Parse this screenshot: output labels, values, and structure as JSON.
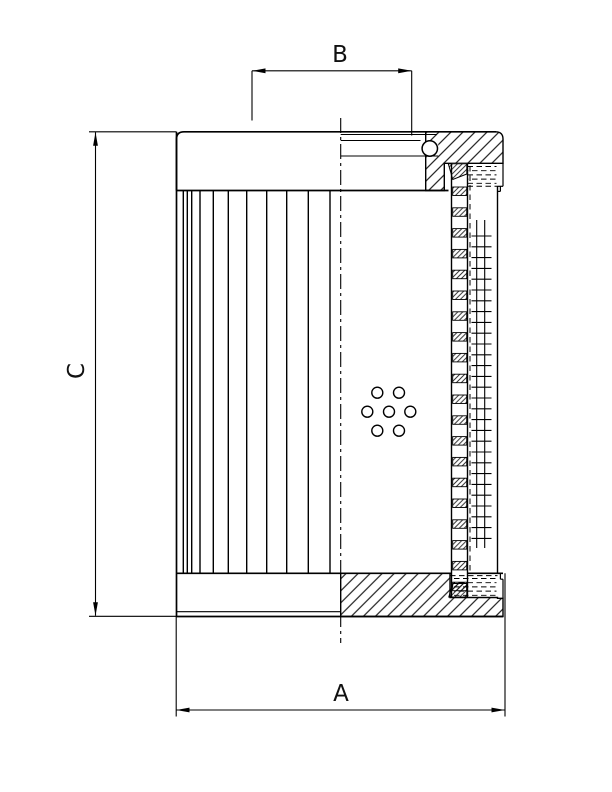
{
  "document": {
    "kind": "technical-section-drawing",
    "background": "#ffffff",
    "line_color": "#000000"
  },
  "labels": {
    "dim_a": "A",
    "dim_b": "B",
    "dim_c": "C"
  },
  "features": {
    "pleats": {
      "y_top": 190.5,
      "y_bottom": 573.3,
      "x_positions": [
        183.3,
        187.3,
        191.7,
        200,
        213.3,
        228.3,
        246.7,
        266.7,
        286.7,
        308.3,
        330
      ]
    },
    "holes": {
      "radius": 5.5,
      "centers": [
        [
          377.3,
          392.7
        ],
        [
          399,
          392.7
        ],
        [
          367.3,
          411.7
        ],
        [
          389,
          411.7
        ],
        [
          410.3,
          411.7
        ],
        [
          377.3,
          430.7
        ],
        [
          399,
          430.7
        ]
      ]
    },
    "perforated_strip": {
      "x": 452.7,
      "width": 14,
      "block_height": 8.5,
      "block_tops": [
        187,
        207.8,
        228.6,
        249.4,
        270.2,
        291,
        311.8,
        332.6,
        353.4,
        374.2,
        395,
        415.8,
        436.6,
        457.4,
        478.2,
        499,
        519.8,
        540.6,
        561.4,
        582.2
      ]
    },
    "mesh": {
      "verticals": [
        476.7,
        484.7
      ],
      "v_y1": 220,
      "v_y2": 548,
      "tick_x1": 471.5,
      "tick_x2": 491.5,
      "tick_ys": [
        236,
        246.8,
        257.6,
        268.4,
        279.2,
        290,
        300.8,
        311.6,
        322.4,
        333.2,
        344,
        354.8,
        365.6,
        376.4,
        387.2,
        398,
        408.8,
        419.6,
        430.4,
        441.2,
        452,
        462.8,
        473.6,
        484.4,
        495.2,
        506,
        516.8,
        527.6,
        538.4
      ]
    },
    "seals": {
      "dash": "5.5 3.5",
      "top": {
        "x1": 467.5,
        "x2": 496.5,
        "ys": [
          166.5,
          170.7,
          174.9,
          179.1,
          183.3
        ]
      },
      "bottom": {
        "x1": 454,
        "x2": 496.5,
        "ys": [
          578.5,
          582.7,
          586.9,
          591.1,
          595.3
        ]
      }
    }
  }
}
